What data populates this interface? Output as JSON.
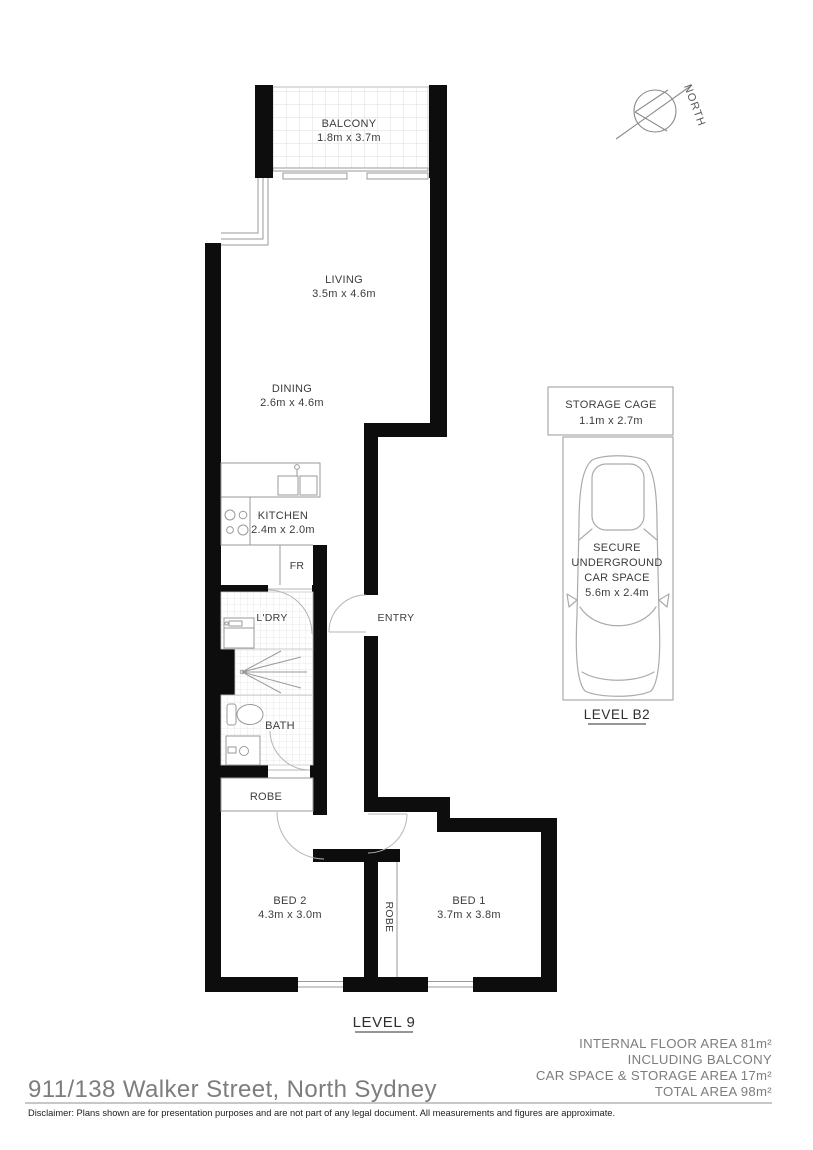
{
  "floor_plan": {
    "address": "911/138 Walker Street, North Sydney",
    "north_label": "NORTH",
    "level_apartment": "LEVEL 9",
    "level_parking": "LEVEL B2",
    "rooms": {
      "balcony": {
        "name": "BALCONY",
        "dims": "1.8m x 3.7m"
      },
      "living": {
        "name": "LIVING",
        "dims": "3.5m x 4.6m"
      },
      "dining": {
        "name": "DINING",
        "dims": "2.6m x 4.6m"
      },
      "kitchen": {
        "name": "KITCHEN",
        "dims": "2.4m x 2.0m"
      },
      "fridge": {
        "name": "FR"
      },
      "laundry": {
        "name": "L'DRY"
      },
      "entry": {
        "name": "ENTRY"
      },
      "bath": {
        "name": "BATH"
      },
      "robe": {
        "name": "ROBE"
      },
      "bed2": {
        "name": "BED 2",
        "dims": "4.3m x 3.0m"
      },
      "bed2_robe": {
        "name": "ROBE"
      },
      "bed1": {
        "name": "BED 1",
        "dims": "3.7m x 3.8m"
      },
      "storage_cage": {
        "name": "STORAGE CAGE",
        "dims": "1.1m x 2.7m"
      },
      "car_space": {
        "line1": "SECURE",
        "line2": "UNDERGROUND",
        "line3": "CAR SPACE",
        "dims": "5.6m x 2.4m"
      }
    },
    "areas": {
      "internal": "INTERNAL FLOOR AREA 81m²",
      "including": "INCLUDING BALCONY",
      "car_storage": "CAR SPACE & STORAGE AREA 17m²",
      "total": "TOTAL AREA 98m²"
    },
    "disclaimer": "Disclaimer: Plans shown are for presentation purposes and are not part of any legal document. All measurements and figures are approximate.",
    "colors": {
      "wall": "#0d0d0d",
      "outline": "#9a9a9a",
      "text": "#3c3c3c",
      "muted": "#7d7d7d"
    }
  }
}
